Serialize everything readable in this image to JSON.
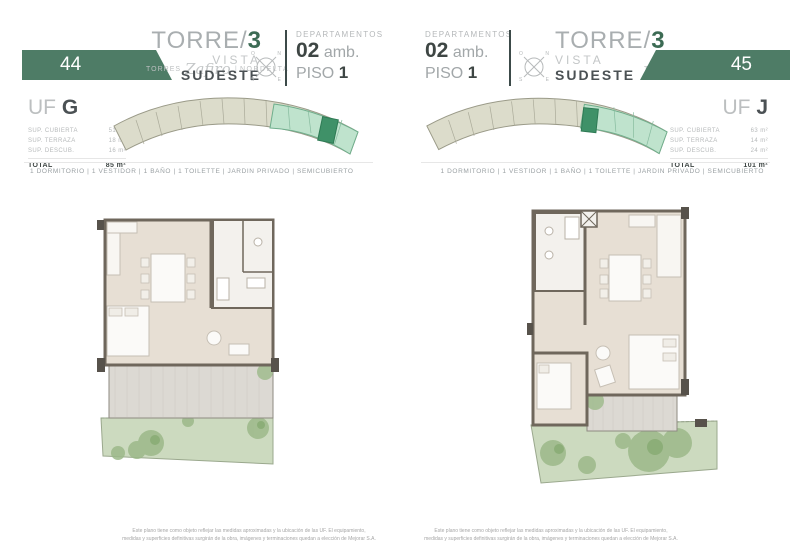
{
  "colors": {
    "brand_green": "#4e7c66",
    "accent_green": "#3c6b54",
    "keyplan_highlight": "#bfe3cd",
    "keyplan_unit": "#3f9168",
    "plan_floor": "#e7dfd4",
    "plan_wall": "#6f675c",
    "garden_green": "#ccdabf",
    "terrace_grey": "#dcd9d3"
  },
  "compass": {
    "n": "N",
    "s": "S",
    "e": "E",
    "o": "O"
  },
  "pages": [
    {
      "number": "44",
      "brand": {
        "prefix": "Torres",
        "script": "Zafiro",
        "sep": "|",
        "suffix": "NORDELTA"
      },
      "title": {
        "torre": "TORRE/",
        "num": "3",
        "vista": "VISTA",
        "direction": "SUDESTE"
      },
      "dept": {
        "label": "DEPARTAMENTOS",
        "num": "02",
        "amb": "amb.",
        "piso": "PISO",
        "piso_num": "1"
      },
      "unit": {
        "prefix": "UF",
        "letter": "G",
        "rows": [
          {
            "label": "SUP. CUBIERTA",
            "value": "51 m²"
          },
          {
            "label": "SUP. TERRAZA",
            "value": "18 m²"
          },
          {
            "label": "SUP. DESCUB.",
            "value": "16 m²"
          }
        ],
        "total_label": "TOTAL",
        "total_value": "85 m²"
      },
      "amenities": "1 DORMITORIO | 1 VESTIDOR | 1 BAÑO | 1 TOILETTE | JARDIN PRIVADO | SEMICUBIERTO",
      "disclaimer_line1": "Este plano tiene como objeto reflejar las medidas aproximadas y la ubicación de las UF. El equipamiento,",
      "disclaimer_line2": "medidas y superficies definitivas surgirán de la obra, imágenes y terminaciones quedan a elección de Mejorar S.A."
    },
    {
      "number": "45",
      "brand": {
        "prefix": "Torres",
        "script": "Zafiro",
        "sep": "|",
        "suffix": "NORDELTA"
      },
      "title": {
        "torre": "TORRE/",
        "num": "3",
        "vista": "VISTA",
        "direction": "SUDESTE"
      },
      "dept": {
        "label": "DEPARTAMENTOS",
        "num": "02",
        "amb": "amb.",
        "piso": "PISO",
        "piso_num": "1"
      },
      "unit": {
        "prefix": "UF",
        "letter": "J",
        "rows": [
          {
            "label": "SUP. CUBIERTA",
            "value": "63 m²"
          },
          {
            "label": "SUP. TERRAZA",
            "value": "14 m²"
          },
          {
            "label": "SUP. DESCUB.",
            "value": "24 m²"
          }
        ],
        "total_label": "TOTAL",
        "total_value": "101 m²"
      },
      "amenities": "1 DORMITORIO | 1 VESTIDOR | 1 BAÑO | 1 TOILETTE | JARDIN PRIVADO | SEMICUBIERTO",
      "disclaimer_line1": "Este plano tiene como objeto reflejar las medidas aproximadas y la ubicación de las UF. El equipamiento,",
      "disclaimer_line2": "medidas y superficies definitivas surgirán de la obra, imágenes y terminaciones quedan a elección de Mejorar S.A."
    }
  ]
}
